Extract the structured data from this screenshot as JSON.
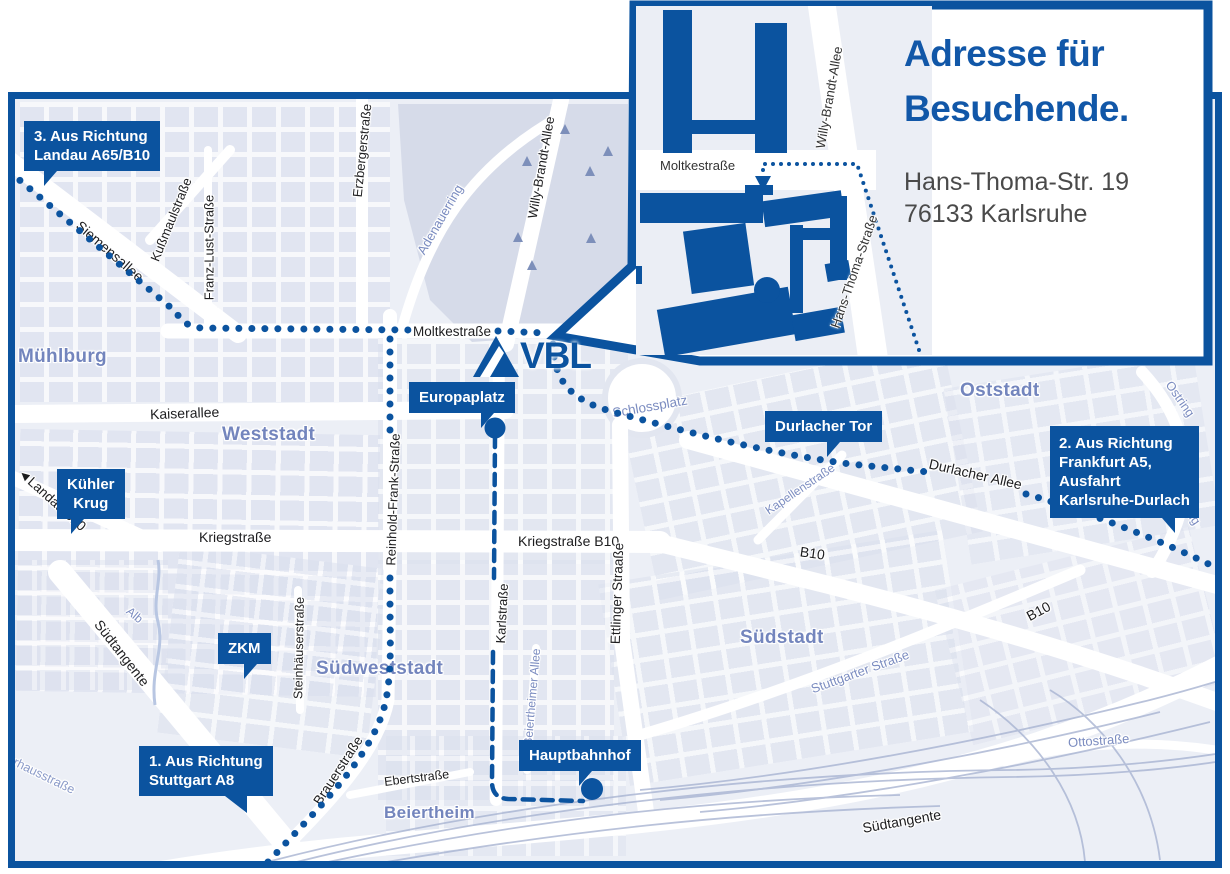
{
  "colors": {
    "primary_blue": "#0b539f",
    "map_background": "#eceff6",
    "district_label": "#7385bd",
    "street_label": "#1d1d1f",
    "blue_street_label": "#7b8cc0",
    "title_blue": "#1157a8",
    "address_text": "#4a4a4a"
  },
  "inset": {
    "title_line1": "Adresse für",
    "title_line2": "Besuchende.",
    "address_line1": "Hans-Thoma-Str. 19",
    "address_line2": "76133 Karlsruhe",
    "streets": {
      "moltkestrasse": "Moltkestraße",
      "willy_brandt_allee": "Willy-Brandt-Allee",
      "hans_thoma_strasse": "Hans-Thoma-Straße"
    }
  },
  "logo": {
    "text": "VBL"
  },
  "callouts": {
    "landau": {
      "line1": "3. Aus Richtung",
      "line2": "Landau A65/B10"
    },
    "frankfurt": {
      "line1": "2. Aus Richtung",
      "line2": "Frankfurt A5,",
      "line3": "Ausfahrt",
      "line4": "Karlsruhe-Durlach"
    },
    "stuttgart": {
      "line1": "1. Aus Richtung",
      "line2": "Stuttgart A8"
    },
    "kuehler_krug": {
      "line1": "Kühler",
      "line2": "Krug"
    },
    "zkm": {
      "label": "ZKM"
    },
    "europaplatz": {
      "label": "Europaplatz"
    },
    "durlacher_tor": {
      "label": "Durlacher Tor"
    },
    "hauptbahnhof": {
      "label": "Hauptbahnhof"
    }
  },
  "districts": {
    "muehlburg": "Mühlburg",
    "weststadt": "Weststadt",
    "oststadt": "Oststadt",
    "suedweststadt": "Südweststadt",
    "suedstadt": "Südstadt",
    "beiertheim": "Beiertheim"
  },
  "streets": {
    "siemensallee": "Siemensallee",
    "kussmaulstrasse": "Kußmaulstraße",
    "franz_lust_strasse": "Franz-Lust-Straße",
    "erzbergerstrasse": "Erzbergerstraße",
    "adenauerring": "Adenauerring",
    "willy_brandt_allee": "Willy-Brandt-Allee",
    "moltkestrasse": "Moltkestraße",
    "kaiserallee": "Kaiserallee",
    "reinhold_frank_strasse": "Reinhold-Frank-Straße",
    "kriegstrasse": "Kriegstraße",
    "kriegstrasse_b10": "Kriegstraße B10",
    "karlstrasse": "Karlstraße",
    "ettlinger_strasse": "Ettlinger Straaße",
    "schlossplatz": "Schlossplatz",
    "durlacher_allee": "Durlacher Allee",
    "kapellenstrasse": "Kapellenstraße",
    "b10_kriegstrasse": "B10",
    "b10_east": "B10",
    "landau_b10_arrow": "◄",
    "landau_b10": "Landau B10",
    "stuttgarter_strasse": "Stuttgarter Straße",
    "suedtangente_west": "Südtangente",
    "suedtangente_sued": "Südtangente",
    "alb": "Alb",
    "steinhaeuserstrasse": "Steinhäuserstraße",
    "brauerstrasse": "Brauerstraße",
    "ebertstrasse": "Ebertstraße",
    "beiertheimer_allee": "Beiertheimer Allee",
    "ottostrasse": "Ottostraße",
    "pulverhausstrasse": "Pulverhausstraße",
    "ostring_nord": "Ostring",
    "ostring_sued": "Ostring",
    "fragment_we": "we",
    "fragment_ein": "ein"
  }
}
